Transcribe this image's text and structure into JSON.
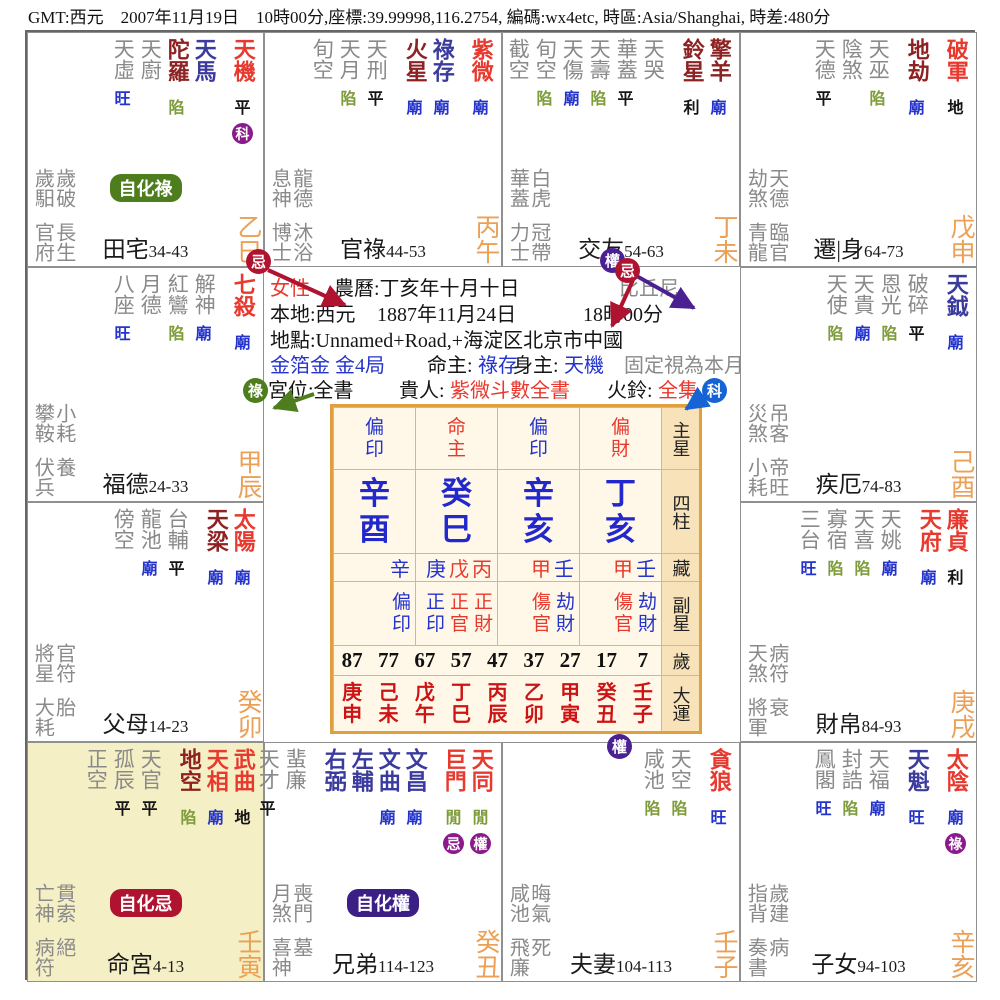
{
  "header": {
    "text": "GMT:西元　2007年11月19日　10時00分,座標:39.99998,116.2754, 編碼:wx4etc, 時區:Asia/Shanghai, 時差:480分"
  },
  "colors": {
    "star_red": "#e8392e",
    "star_maroon": "#8e2222",
    "star_navy": "#3b3b9e",
    "star_gray": "#8a8a8a",
    "status_blue": "#2433cc",
    "status_green": "#7e9c3a",
    "status_black": "#151515",
    "stem_orange": "#eca055",
    "badge_purple": "#8b1a8b",
    "badge_crimson": "#b01330",
    "badge_green": "#4e7d1e",
    "badge_blue": "#1663d6",
    "badge_indigo": "#4b2191",
    "pillar_blue": "#2228cc",
    "dayun_red": "#cc1414",
    "table_border": "#e0a040",
    "highlight_bg": "#f5efc5"
  },
  "palaces": [
    {
      "id": "si",
      "col": 0,
      "row": 0,
      "name": "田宅",
      "range": "34-43",
      "stem": "乙巳",
      "stars": [
        {
          "n": "天虛",
          "c": "gray",
          "s": "旺",
          "sc": "b"
        },
        {
          "n": "天廚",
          "c": "gray"
        },
        {
          "n": "陀羅",
          "c": "maroon",
          "s": "陷",
          "sc": "g"
        },
        {
          "n": "天馬",
          "c": "navy"
        },
        {
          "n": "天機",
          "c": "red",
          "s": "平",
          "sc": "k",
          "badge": "科",
          "g": 1
        }
      ],
      "g1": [
        "歲馹",
        "歲破"
      ],
      "g2": [
        "官府",
        "長生"
      ],
      "pill": {
        "t": "自化祿",
        "c": "#4e7d1e"
      }
    },
    {
      "id": "wu",
      "col": 1,
      "row": 0,
      "name": "官祿",
      "range": "44-53",
      "stem": "丙午",
      "stars": [
        {
          "n": "旬空",
          "c": "gray"
        },
        {
          "n": "天月",
          "c": "gray",
          "s": "陷",
          "sc": "g"
        },
        {
          "n": "天刑",
          "c": "gray",
          "s": "平",
          "sc": "k"
        },
        {
          "n": "火星",
          "c": "maroon",
          "s": "廟",
          "sc": "b",
          "g": 1
        },
        {
          "n": "祿存",
          "c": "navy",
          "s": "廟",
          "sc": "b"
        },
        {
          "n": "紫微",
          "c": "red",
          "s": "廟",
          "sc": "b",
          "g": 1
        }
      ],
      "g1": [
        "息神",
        "龍德"
      ],
      "g2": [
        "博士",
        "沐浴"
      ]
    },
    {
      "id": "wei",
      "col": 2,
      "row": 0,
      "name": "交友",
      "range": "54-63",
      "stem": "丁未",
      "stars": [
        {
          "n": "截空",
          "c": "gray"
        },
        {
          "n": "旬空",
          "c": "gray",
          "s": "陷",
          "sc": "g"
        },
        {
          "n": "天傷",
          "c": "gray",
          "s": "廟",
          "sc": "b"
        },
        {
          "n": "天壽",
          "c": "gray",
          "s": "陷",
          "sc": "g"
        },
        {
          "n": "華蓋",
          "c": "gray",
          "s": "平",
          "sc": "k"
        },
        {
          "n": "天哭",
          "c": "gray"
        },
        {
          "n": "鈴星",
          "c": "maroon",
          "s": "利",
          "sc": "k",
          "g": 1
        },
        {
          "n": "擎羊",
          "c": "maroon",
          "s": "廟",
          "sc": "b"
        }
      ],
      "g1": [
        "華蓋",
        "白虎"
      ],
      "g2": [
        "力士",
        "冠帶"
      ]
    },
    {
      "id": "shen",
      "col": 3,
      "row": 0,
      "name": "遷|身",
      "range": "64-73",
      "stem": "戊申",
      "stars": [
        {
          "n": "天德",
          "c": "gray",
          "s": "平",
          "sc": "k"
        },
        {
          "n": "陰煞",
          "c": "gray"
        },
        {
          "n": "天巫",
          "c": "gray",
          "s": "陷",
          "sc": "g"
        },
        {
          "n": "地劫",
          "c": "maroon",
          "s": "廟",
          "sc": "b",
          "g": 1
        },
        {
          "n": "破軍",
          "c": "red",
          "s": "地",
          "sc": "k",
          "g": 1
        }
      ],
      "g1": [
        "劫煞",
        "天德"
      ],
      "g2": [
        "青龍",
        "臨官"
      ]
    },
    {
      "id": "chen",
      "col": 0,
      "row": 1,
      "name": "福德",
      "range": "24-33",
      "stem": "甲辰",
      "stars": [
        {
          "n": "八座",
          "c": "gray",
          "s": "旺",
          "sc": "b"
        },
        {
          "n": "月德",
          "c": "gray"
        },
        {
          "n": "紅鸞",
          "c": "gray",
          "s": "陷",
          "sc": "g"
        },
        {
          "n": "解神",
          "c": "gray",
          "s": "廟",
          "sc": "b"
        },
        {
          "n": "七殺",
          "c": "red",
          "s": "廟",
          "sc": "b",
          "g": 1
        }
      ],
      "g1": [
        "攀鞍",
        "小耗"
      ],
      "g2": [
        "伏兵",
        "養"
      ]
    },
    {
      "id": "you",
      "col": 3,
      "row": 1,
      "name": "疾厄",
      "range": "74-83",
      "stem": "己酉",
      "stars": [
        {
          "n": "天使",
          "c": "gray",
          "s": "陷",
          "sc": "g"
        },
        {
          "n": "天貴",
          "c": "gray",
          "s": "廟",
          "sc": "b"
        },
        {
          "n": "恩光",
          "c": "gray",
          "s": "陷",
          "sc": "g"
        },
        {
          "n": "破碎",
          "c": "gray",
          "s": "平",
          "sc": "k"
        },
        {
          "n": "天鉞",
          "c": "navy",
          "s": "廟",
          "sc": "b",
          "g": 1
        }
      ],
      "g1": [
        "災煞",
        "吊客"
      ],
      "g2": [
        "小耗",
        "帝旺"
      ]
    },
    {
      "id": "mao",
      "col": 0,
      "row": 2,
      "name": "父母",
      "range": "14-23",
      "stem": "癸卯",
      "stars": [
        {
          "n": "傍空",
          "c": "gray"
        },
        {
          "n": "龍池",
          "c": "gray",
          "s": "廟",
          "sc": "b"
        },
        {
          "n": "台輔",
          "c": "gray",
          "s": "平",
          "sc": "k"
        },
        {
          "n": "天梁",
          "c": "maroon",
          "s": "廟",
          "sc": "b",
          "g": 1
        },
        {
          "n": "太陽",
          "c": "red",
          "s": "廟",
          "sc": "b"
        }
      ],
      "g1": [
        "將星",
        "官符"
      ],
      "g2": [
        "大耗",
        "胎"
      ]
    },
    {
      "id": "xu",
      "col": 3,
      "row": 2,
      "name": "財帛",
      "range": "84-93",
      "stem": "庚戌",
      "stars": [
        {
          "n": "三台",
          "c": "gray",
          "s": "旺",
          "sc": "b"
        },
        {
          "n": "寡宿",
          "c": "gray",
          "s": "陷",
          "sc": "g"
        },
        {
          "n": "天喜",
          "c": "gray",
          "s": "陷",
          "sc": "g"
        },
        {
          "n": "天姚",
          "c": "gray",
          "s": "廟",
          "sc": "b"
        },
        {
          "n": "天府",
          "c": "red",
          "s": "廟",
          "sc": "b",
          "g": 1
        },
        {
          "n": "廉貞",
          "c": "red",
          "s": "利",
          "sc": "k"
        }
      ],
      "g1": [
        "天煞",
        "病符"
      ],
      "g2": [
        "將軍",
        "衰"
      ]
    },
    {
      "id": "yin",
      "col": 0,
      "row": 3,
      "name": "命宮",
      "range": "4-13",
      "stem": "壬寅",
      "hl": 1,
      "stars": [
        {
          "n": "正空",
          "c": "gray"
        },
        {
          "n": "孤辰",
          "c": "gray",
          "s": "平",
          "sc": "k"
        },
        {
          "n": "天官",
          "c": "gray",
          "s": "平",
          "sc": "k"
        },
        {
          "n": "地空",
          "c": "maroon",
          "s": "陷",
          "sc": "g",
          "g": 1
        },
        {
          "n": "天相",
          "c": "red",
          "s": "廟",
          "sc": "b"
        },
        {
          "n": "武曲",
          "c": "red",
          "s": "地",
          "sc": "k"
        }
      ],
      "g1": [
        "亡神",
        "貫索"
      ],
      "g2": [
        "病符",
        "絕"
      ],
      "pill": {
        "t": "自化忌",
        "c": "#b01330"
      }
    },
    {
      "id": "chou",
      "col": 1,
      "row": 3,
      "name": "兄弟",
      "range": "114-123",
      "stem": "癸丑",
      "stars": [
        {
          "n": "天才",
          "c": "gray",
          "s": "平",
          "sc": "k"
        },
        {
          "n": "蜚廉",
          "c": "gray"
        },
        {
          "n": "右弼",
          "c": "navy",
          "g": 1
        },
        {
          "n": "左輔",
          "c": "navy"
        },
        {
          "n": "文曲",
          "c": "navy",
          "s": "廟",
          "sc": "b"
        },
        {
          "n": "文昌",
          "c": "navy",
          "s": "廟",
          "sc": "b"
        },
        {
          "n": "巨門",
          "c": "red",
          "s": "閒",
          "sc": "g",
          "badge": "忌",
          "g": 1
        },
        {
          "n": "天同",
          "c": "red",
          "s": "閒",
          "sc": "g",
          "badge": "權"
        }
      ],
      "g1": [
        "月煞",
        "喪門"
      ],
      "g2": [
        "喜神",
        "墓"
      ],
      "pill": {
        "t": "自化權",
        "c": "#3c1f85"
      }
    },
    {
      "id": "zi",
      "col": 2,
      "row": 3,
      "name": "夫妻",
      "range": "104-113",
      "stem": "壬子",
      "stars": [
        {
          "n": "咸池",
          "c": "gray",
          "s": "陷",
          "sc": "g"
        },
        {
          "n": "天空",
          "c": "gray",
          "s": "陷",
          "sc": "g"
        },
        {
          "n": "貪狼",
          "c": "red",
          "s": "旺",
          "sc": "b",
          "g": 1
        }
      ],
      "g1": [
        "咸池",
        "晦氣"
      ],
      "g2": [
        "飛廉",
        "死"
      ]
    },
    {
      "id": "hai",
      "col": 3,
      "row": 3,
      "name": "子女",
      "range": "94-103",
      "stem": "辛亥",
      "stars": [
        {
          "n": "鳳閣",
          "c": "gray",
          "s": "旺",
          "sc": "b"
        },
        {
          "n": "封誥",
          "c": "gray",
          "s": "陷",
          "sc": "g"
        },
        {
          "n": "天福",
          "c": "gray",
          "s": "廟",
          "sc": "b"
        },
        {
          "n": "天魁",
          "c": "navy",
          "s": "旺",
          "sc": "b",
          "g": 1
        },
        {
          "n": "太陰",
          "c": "red",
          "s": "廟",
          "sc": "b",
          "badge": "祿",
          "g": 1
        }
      ],
      "g1": [
        "指背",
        "歲建"
      ],
      "g2": [
        "奏書",
        "病"
      ]
    }
  ],
  "center": {
    "lines": [
      {
        "y": 240,
        "segs": [
          {
            "t": "女性",
            "x": 243,
            "c": "red"
          },
          {
            "t": "農曆:丁亥年十月十日",
            "x": 307,
            "c": "k"
          },
          {
            "t": "比丘尼",
            "x": 592,
            "c": "gray"
          }
        ]
      },
      {
        "y": 266,
        "segs": [
          {
            "t": "本地:西元",
            "x": 243,
            "c": "k"
          },
          {
            "t": "1887年11月24日",
            "x": 350,
            "c": "k"
          },
          {
            "t": "18時00分",
            "x": 556,
            "c": "k"
          }
        ]
      },
      {
        "y": 292,
        "segs": [
          {
            "t": "地點:Unnamed+Road,+海淀区北京市中國",
            "x": 243,
            "c": "k"
          }
        ]
      },
      {
        "y": 317,
        "segs": [
          {
            "t": "金箔金 金4局",
            "x": 243,
            "c": "blue"
          },
          {
            "t": "命主:",
            "x": 400,
            "c": "k"
          },
          {
            "t": "祿存",
            "x": 451,
            "c": "blue"
          },
          {
            "t": "身主:",
            "x": 486,
            "c": "k"
          },
          {
            "t": "天機",
            "x": 537,
            "c": "blue"
          },
          {
            "t": "固定視為本月",
            "x": 597,
            "c": "gray"
          }
        ]
      },
      {
        "y": 342,
        "segs": [
          {
            "t": "宮位:全書",
            "x": 241,
            "c": "k"
          },
          {
            "t": "貴人:",
            "x": 372,
            "c": "k"
          },
          {
            "t": "紫微斗數全書",
            "x": 423,
            "c": "red"
          },
          {
            "t": "火鈴:",
            "x": 580,
            "c": "k"
          },
          {
            "t": "全集",
            "x": 631,
            "c": "red"
          }
        ]
      }
    ],
    "table": {
      "row_labels": [
        "主星",
        "四柱",
        "藏",
        "副星",
        "歲",
        "大運"
      ],
      "pillars": [
        {
          "top": "偏印",
          "tc": "red_no",
          "topc": "blue",
          "gz": "辛酉",
          "hidden": [
            {
              "t": "辛",
              "c": "blue"
            }
          ],
          "sub": [
            {
              "t": "偏印",
              "c": "blue"
            }
          ]
        },
        {
          "top": "命主",
          "topc": "red",
          "gz": "癸巳",
          "hidden": [
            {
              "t": "庚",
              "c": "blue"
            },
            {
              "t": "戊",
              "c": "red"
            },
            {
              "t": "丙",
              "c": "red"
            }
          ],
          "sub": [
            {
              "t": "正印",
              "c": "blue"
            },
            {
              "t": "正官",
              "c": "red"
            },
            {
              "t": "正財",
              "c": "red"
            }
          ]
        },
        {
          "top": "偏印",
          "topc": "blue",
          "gz": "辛亥",
          "hidden": [
            {
              "t": "甲",
              "c": "red"
            },
            {
              "t": "壬",
              "c": "blue"
            }
          ],
          "sub": [
            {
              "t": "傷官",
              "c": "red"
            },
            {
              "t": "劫財",
              "c": "blue"
            }
          ]
        },
        {
          "top": "偏財",
          "topc": "red",
          "gz": "丁亥",
          "hidden": [
            {
              "t": "甲",
              "c": "red"
            },
            {
              "t": "壬",
              "c": "blue"
            }
          ],
          "sub": [
            {
              "t": "傷官",
              "c": "red"
            },
            {
              "t": "劫財",
              "c": "blue"
            }
          ]
        }
      ],
      "ages": [
        "87",
        "77",
        "67",
        "57",
        "47",
        "37",
        "27",
        "17",
        "7"
      ],
      "dayun": [
        "庚申",
        "己未",
        "戊午",
        "丁巳",
        "丙辰",
        "乙卯",
        "甲寅",
        "癸丑",
        "壬子"
      ]
    }
  },
  "overlays": {
    "badges": [
      {
        "t": "忌",
        "c": "#b01330",
        "x": 231,
        "y": 229
      },
      {
        "t": "權",
        "c": "#4b2191",
        "x": 585,
        "y": 228
      },
      {
        "t": "忌",
        "c": "#b01330",
        "x": 600,
        "y": 238
      },
      {
        "t": "祿",
        "c": "#4e7d1e",
        "x": 228,
        "y": 358
      },
      {
        "t": "科",
        "c": "#1663d6",
        "x": 687,
        "y": 358
      },
      {
        "t": "權",
        "c": "#4b2191",
        "x": 592,
        "y": 714
      }
    ],
    "arrows": [
      {
        "c": "#b01330",
        "x1": 241,
        "y1": 238,
        "x2": 318,
        "y2": 273
      },
      {
        "c": "#4b2191",
        "x1": 597,
        "y1": 237,
        "x2": 667,
        "y2": 276
      },
      {
        "c": "#b01330",
        "x1": 606,
        "y1": 248,
        "x2": 585,
        "y2": 294
      },
      {
        "c": "#4e7d1e",
        "x1": 287,
        "y1": 362,
        "x2": 247,
        "y2": 376
      },
      {
        "c": "#1663d6",
        "x1": 681,
        "y1": 362,
        "x2": 659,
        "y2": 377
      }
    ]
  }
}
